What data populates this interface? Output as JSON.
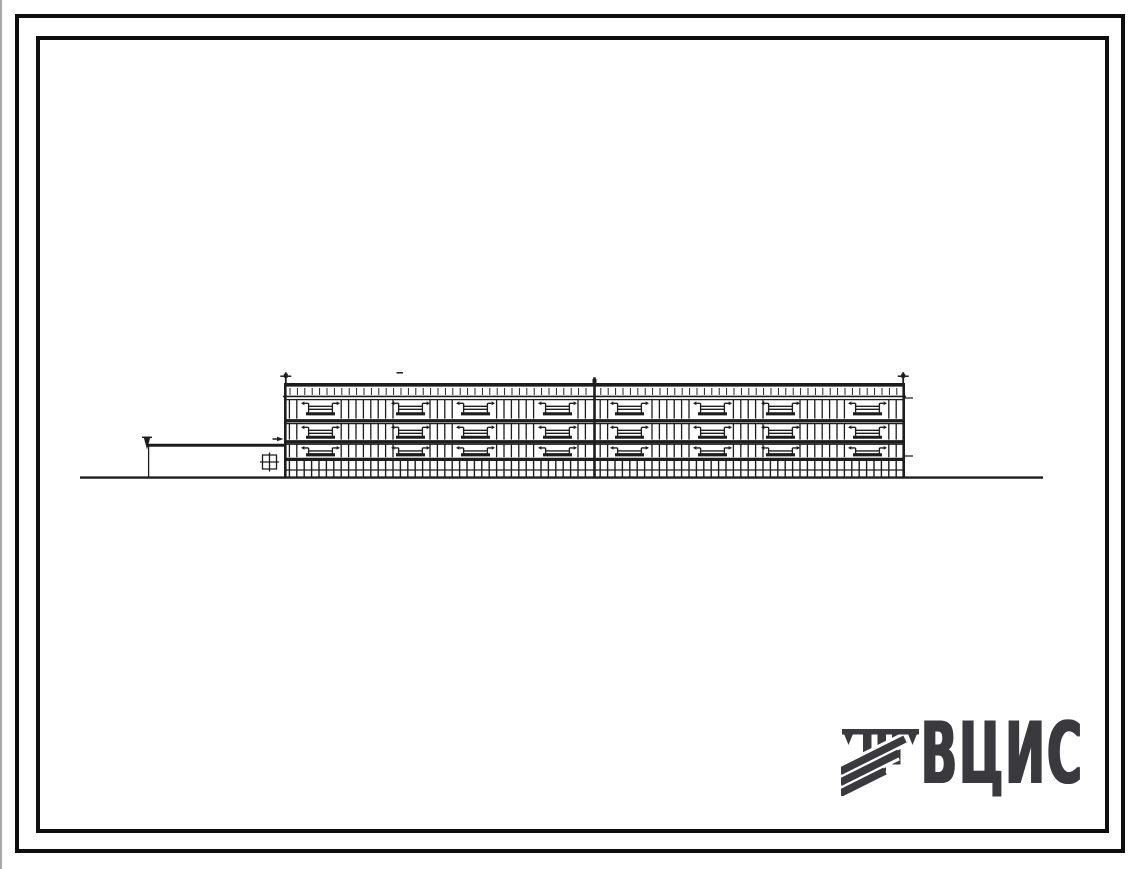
{
  "page": {
    "background": "#ffffff",
    "scan_edge_color": "#a9a9a9",
    "subject": "scanned standard-design album sheet: side elevation of a 3-storey building with single-storey annex"
  },
  "frame": {
    "ink": "#0e0e0e",
    "outer": {
      "x": 15,
      "y": 14,
      "w": 1110,
      "h": 839,
      "thickness": 4
    },
    "inner": {
      "x": 36,
      "y": 36,
      "w": 1073,
      "h": 797,
      "thickness": 4
    }
  },
  "logo": {
    "text": "ВЦИС",
    "color": "#3a3a3e",
    "icon": "vcis-hatched-emblem"
  },
  "drawing": {
    "ink": "#1d1d1d",
    "ground": {
      "x1": 80,
      "x2": 1043,
      "y": 477.6,
      "weight": 2.4
    },
    "annex": {
      "left": 148,
      "roof_y": 445.2,
      "ground_y": 477.6,
      "marker_x": 147,
      "marker_top": 436.5,
      "window": {
        "x": 262.5,
        "y": 455,
        "size": 14
      }
    },
    "building": {
      "left": 284,
      "right": 905,
      "top": 384.8,
      "ground_y": 477.6,
      "divider_x": 594.5,
      "divider_top": 377.4,
      "parapet_line_y": 396.4,
      "parapet_tick_spacing": 7.4,
      "mullion_spacing": 7.4,
      "floors": [
        {
          "win_top": 399.6,
          "win_bottom": 418.6,
          "slab_y": 420.8
        },
        {
          "win_top": 423.6,
          "win_bottom": 439.6,
          "slab_y": 441.8
        },
        {
          "win_top": 444.2,
          "win_bottom": 457.2,
          "slab_y": 459.4
        }
      ],
      "base": {
        "top": 460.8,
        "mid_y": 470,
        "bottom": 477.2,
        "spacing": 7.4
      },
      "balcony_x": [
        306,
        396,
        461,
        543,
        615,
        698,
        766,
        853
      ],
      "balcony_width": 29,
      "axis_marks": [
        {
          "x": 285.8,
          "top": 372.2,
          "tick": true
        },
        {
          "x": 594.5,
          "top": 377.4,
          "tick": false
        },
        {
          "x": 903.2,
          "top": 372.2,
          "tick": true
        }
      ],
      "right_ticks_y": [
        398,
        456
      ],
      "left_arrow_y": 439,
      "roof_dash": {
        "x": 396.5,
        "y": 372.8,
        "len": 6.5
      }
    }
  }
}
